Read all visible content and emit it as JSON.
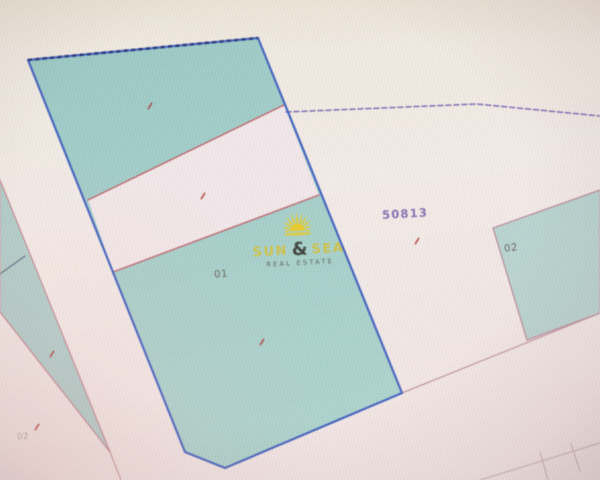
{
  "app": {
    "description": "photo of a cadastral parcel map on a screen"
  },
  "labels": {
    "parcel_number": "50813",
    "subparcel_main": "01",
    "subparcel_right": "02",
    "subparcel_left": "02"
  },
  "watermark": {
    "word1": "SUN",
    "ampersand": "&",
    "word2": "SEA",
    "tagline": "REAL ESTATE",
    "sun": {
      "color": "#eec80e",
      "rays": 11,
      "inner": 9,
      "outer_min": 14,
      "outer_max": 20,
      "half_width": 0.13
    }
  },
  "colors": {
    "background_top": "#efe9db",
    "background_mid": "#f3ebe6",
    "background_bottom": "#f2e6e3",
    "teal_top": "#96c9c3",
    "teal_bottom": "#a9d2cb",
    "teal_right": "#b5d3ce",
    "teal_left": "#aecdc8",
    "blue_border": "#3d5fc3",
    "blue_dash": "#20307c",
    "red_line": "#c0616c",
    "pink_line": "#c5868f",
    "purple_dash": "#7c68b4",
    "mark_red": "#b43430"
  },
  "map": {
    "parcels": [
      {
        "name": "parcel-left-wedge",
        "points": [
          [
            0,
            180
          ],
          [
            110,
            452
          ],
          [
            0,
            312
          ]
        ],
        "fill": "#aecdc8",
        "stroke": "#c5868f",
        "width": 1.2
      },
      {
        "name": "parcel-main",
        "points": [
          [
            28,
            60
          ],
          [
            258,
            38
          ],
          [
            402,
            393
          ],
          [
            225,
            468
          ],
          [
            185,
            452
          ]
        ],
        "fill": "url(#tealGrad)",
        "stroke": "none",
        "width": 0
      },
      {
        "name": "parcel-main-band",
        "points": [
          [
            88,
            200
          ],
          [
            284,
            105
          ],
          [
            319,
            195
          ],
          [
            113,
            272
          ]
        ],
        "fill": "#f2e7e8",
        "stroke": "none",
        "width": 0
      },
      {
        "name": "parcel-right",
        "points": [
          [
            493,
            228
          ],
          [
            600,
            190
          ],
          [
            600,
            313
          ],
          [
            527,
            340
          ]
        ],
        "fill": "#b5d3ce",
        "stroke": "#bb8a9b",
        "width": 1.3
      }
    ],
    "lines": [
      {
        "name": "band-top-line",
        "points": [
          [
            88,
            200
          ],
          [
            284,
            105
          ]
        ],
        "stroke": "#c0616c",
        "width": 1.4
      },
      {
        "name": "band-bottom-line",
        "points": [
          [
            113,
            272
          ],
          [
            319,
            195
          ]
        ],
        "stroke": "#c0616c",
        "width": 1.4
      },
      {
        "name": "boundary-dashed-purple",
        "points": [
          [
            286,
            112
          ],
          [
            477,
            104
          ],
          [
            600,
            116
          ]
        ],
        "stroke": "#7c68b4",
        "width": 1.5,
        "dash": "5 3"
      },
      {
        "name": "boundary-bottom-right",
        "points": [
          [
            402,
            393
          ],
          [
            600,
            313
          ]
        ],
        "stroke": "#c295a1",
        "width": 1.3
      },
      {
        "name": "left-dark-line",
        "points": [
          [
            0,
            274
          ],
          [
            25,
            256
          ]
        ],
        "stroke": "#5e6f83",
        "width": 1.3
      },
      {
        "name": "wedge-tip-line",
        "points": [
          [
            110,
            452
          ],
          [
            121,
            480
          ]
        ],
        "stroke": "#c5868f",
        "width": 1.0
      },
      {
        "name": "corner-line-1",
        "points": [
          [
            480,
            480
          ],
          [
            600,
            443
          ]
        ],
        "stroke": "#cfb2b6",
        "width": 1.2
      },
      {
        "name": "corner-tick-1",
        "points": [
          [
            540,
            452
          ],
          [
            548,
            480
          ]
        ],
        "stroke": "#cfb2b6",
        "width": 1.2
      },
      {
        "name": "corner-tick-2",
        "points": [
          [
            571,
            444
          ],
          [
            580,
            471
          ]
        ],
        "stroke": "#cfb2b6",
        "width": 1.2
      }
    ],
    "outlines": [
      {
        "name": "parcel-main-border",
        "points": [
          [
            28,
            60
          ],
          [
            258,
            38
          ],
          [
            402,
            393
          ],
          [
            225,
            468
          ],
          [
            185,
            452
          ]
        ],
        "closed": true,
        "stroke": "#3d5fc3",
        "width": 2.2
      },
      {
        "name": "parcel-main-top-dash",
        "points": [
          [
            28,
            60
          ],
          [
            258,
            38
          ]
        ],
        "stroke": "#20307c",
        "width": 2.6,
        "dash": "4 3.4"
      }
    ],
    "marks": [
      {
        "name": "red-mark-top-section",
        "x": 150,
        "y": 106
      },
      {
        "name": "red-mark-band",
        "x": 203,
        "y": 196
      },
      {
        "name": "red-mark-bottom-section",
        "x": 262,
        "y": 342
      },
      {
        "name": "red-mark-left-wedge",
        "x": 52,
        "y": 354
      },
      {
        "name": "red-mark-50813",
        "x": 417,
        "y": 241
      },
      {
        "name": "red-mark-left-02",
        "x": 37,
        "y": 427
      }
    ],
    "mark_color": "#b43430"
  }
}
